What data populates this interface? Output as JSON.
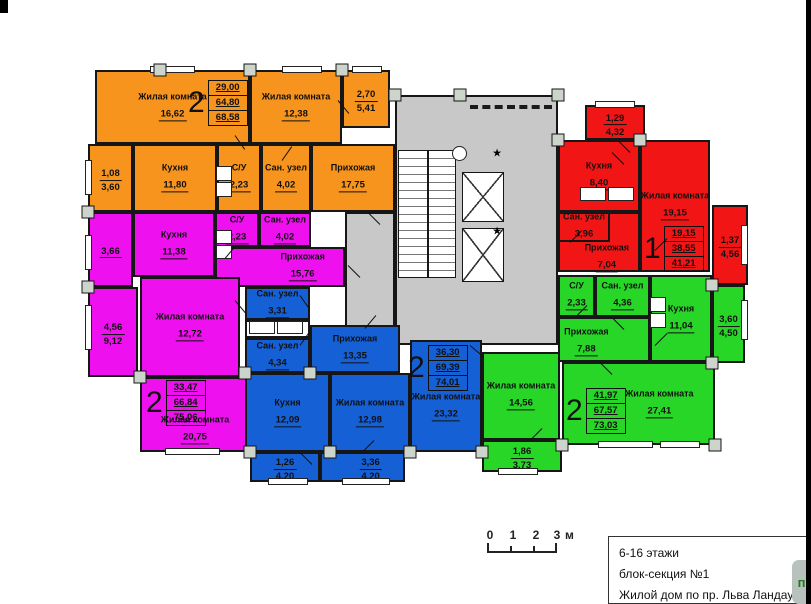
{
  "palette": {
    "or": "#F7941E",
    "mg": "#EE10EE",
    "bl": "#1660D6",
    "gr": "#28D628",
    "rd": "#F21515",
    "gray": "#C8C8C8",
    "white": "#FFFFFF"
  },
  "rooms": [
    {
      "id": "core-hall",
      "c": "gray",
      "x": 395,
      "y": 95,
      "w": 163,
      "h": 250
    },
    {
      "id": "corridor-left",
      "c": "gray",
      "x": 345,
      "y": 212,
      "w": 50,
      "h": 133
    },
    {
      "id": "or-liv1",
      "c": "or",
      "label": "Жилая комната",
      "value": "16,62",
      "x": 95,
      "y": 70,
      "w": 155,
      "h": 74
    },
    {
      "id": "or-liv2",
      "c": "or",
      "label": "Жилая комната",
      "value": "12,38",
      "x": 250,
      "y": 70,
      "w": 92,
      "h": 74
    },
    {
      "id": "or-balc1",
      "c": "or",
      "value": "2,70",
      "value2": "5,41",
      "x": 342,
      "y": 70,
      "w": 48,
      "h": 58
    },
    {
      "id": "or-balc2",
      "c": "or",
      "value": "1,08",
      "value2": "3,60",
      "x": 88,
      "y": 144,
      "w": 45,
      "h": 68
    },
    {
      "id": "or-kitchen",
      "c": "or",
      "label": "Кухня",
      "value": "11,80",
      "x": 133,
      "y": 144,
      "w": 84,
      "h": 68
    },
    {
      "id": "or-su",
      "c": "or",
      "label": "С/У",
      "value": "2,23",
      "x": 217,
      "y": 144,
      "w": 44,
      "h": 68
    },
    {
      "id": "or-san",
      "c": "or",
      "label": "Сан. узел",
      "value": "4,02",
      "x": 261,
      "y": 144,
      "w": 50,
      "h": 68
    },
    {
      "id": "or-hall",
      "c": "or",
      "label": "Прихожая",
      "value": "17,75",
      "x": 311,
      "y": 144,
      "w": 84,
      "h": 68
    },
    {
      "id": "mg-balc1",
      "c": "mg",
      "value": "3,66",
      "x": 88,
      "y": 212,
      "w": 45,
      "h": 75
    },
    {
      "id": "mg-kitchen",
      "c": "mg",
      "label": "Кухня",
      "value": "11,38",
      "x": 133,
      "y": 212,
      "w": 82,
      "h": 65
    },
    {
      "id": "mg-su",
      "c": "mg",
      "label": "С/У",
      "value": "2,23",
      "x": 215,
      "y": 212,
      "w": 44,
      "h": 35
    },
    {
      "id": "mg-san",
      "c": "mg",
      "label": "Сан. узел",
      "value": "4,02",
      "x": 259,
      "y": 212,
      "w": 52,
      "h": 35
    },
    {
      "id": "mg-hall",
      "c": "mg",
      "label": "Прихожая",
      "value": "15,76",
      "x": 215,
      "y": 247,
      "w": 130,
      "h": 40,
      "lx": 0.68
    },
    {
      "id": "mg-liv1",
      "c": "mg",
      "label": "Жилая комната",
      "value": "12,72",
      "x": 140,
      "y": 277,
      "w": 100,
      "h": 100
    },
    {
      "id": "mg-balc2",
      "c": "mg",
      "value": "4,56",
      "value2": "9,12",
      "x": 88,
      "y": 287,
      "w": 50,
      "h": 90
    },
    {
      "id": "mg-liv2",
      "c": "mg",
      "label": "Жилая комната",
      "value": "20,75",
      "x": 140,
      "y": 377,
      "w": 110,
      "h": 75,
      "ly": 0.72
    },
    {
      "id": "bl-san1",
      "c": "bl",
      "label": "Сан. узел",
      "value": "3,31",
      "x": 245,
      "y": 287,
      "w": 65,
      "h": 33
    },
    {
      "id": "bl-shelf",
      "c": "white",
      "x": 245,
      "y": 320,
      "w": 65,
      "h": 18
    },
    {
      "id": "bl-san2",
      "c": "bl",
      "label": "Сан. узел",
      "value": "4,34",
      "x": 245,
      "y": 338,
      "w": 65,
      "h": 35
    },
    {
      "id": "bl-hall",
      "c": "bl",
      "label": "Прихожая",
      "value": "13,35",
      "x": 310,
      "y": 325,
      "w": 90,
      "h": 48
    },
    {
      "id": "bl-kitchen",
      "c": "bl",
      "label": "Кухня",
      "value": "12,09",
      "x": 245,
      "y": 373,
      "w": 85,
      "h": 79
    },
    {
      "id": "bl-liv1",
      "c": "bl",
      "label": "Жилая комната",
      "value": "12,98",
      "x": 330,
      "y": 373,
      "w": 80,
      "h": 79
    },
    {
      "id": "bl-liv2",
      "c": "bl",
      "label": "Жилая комната",
      "value": "23,32",
      "x": 410,
      "y": 340,
      "w": 72,
      "h": 112,
      "ly": 0.6
    },
    {
      "id": "bl-balc1",
      "c": "bl",
      "value": "1,26",
      "value2": "4,20",
      "x": 250,
      "y": 452,
      "w": 70,
      "h": 30
    },
    {
      "id": "bl-balc2",
      "c": "bl",
      "value": "3,36",
      "value2": "4,20",
      "x": 320,
      "y": 452,
      "w": 85,
      "h": 30,
      "lx": 0.6
    },
    {
      "id": "gr-su",
      "c": "gr",
      "label": "С/У",
      "value": "2,33",
      "x": 558,
      "y": 275,
      "w": 37,
      "h": 42
    },
    {
      "id": "gr-san",
      "c": "gr",
      "label": "Сан. узел",
      "value": "4,36",
      "x": 595,
      "y": 275,
      "w": 55,
      "h": 42
    },
    {
      "id": "gr-kitchen",
      "c": "gr",
      "label": "Кухня",
      "value": "11,04",
      "x": 650,
      "y": 275,
      "w": 62,
      "h": 87
    },
    {
      "id": "gr-hall",
      "c": "gr",
      "label": "Прихожая",
      "value": "7,88",
      "x": 558,
      "y": 317,
      "w": 92,
      "h": 45,
      "lx": 0.3,
      "ly": 0.55
    },
    {
      "id": "gr-liv1",
      "c": "gr",
      "label": "Жилая комната",
      "value": "14,56",
      "x": 482,
      "y": 352,
      "w": 78,
      "h": 88
    },
    {
      "id": "gr-liv2",
      "c": "gr",
      "label": "Жилая комната",
      "value": "27,41",
      "x": 562,
      "y": 362,
      "w": 153,
      "h": 83,
      "lx": 0.64
    },
    {
      "id": "gr-balc1",
      "c": "gr",
      "value": "1,86",
      "value2": "3,73",
      "x": 482,
      "y": 440,
      "w": 80,
      "h": 32
    },
    {
      "id": "gr-balc2",
      "c": "gr",
      "value": "3,60",
      "value2": "4,50",
      "x": 712,
      "y": 285,
      "w": 33,
      "h": 78
    },
    {
      "id": "rd-balc1",
      "c": "rd",
      "value": "1,29",
      "value2": "4,32",
      "x": 585,
      "y": 105,
      "w": 60,
      "h": 35
    },
    {
      "id": "rd-kitchen",
      "c": "rd",
      "label": "Кухня",
      "value": "8,40",
      "x": 558,
      "y": 140,
      "w": 82,
      "h": 72
    },
    {
      "id": "rd-liv",
      "c": "rd",
      "label": "Жилая комната",
      "value": "19,15",
      "x": 640,
      "y": 140,
      "w": 70,
      "h": 132
    },
    {
      "id": "rd-hall",
      "c": "rd",
      "label": "Прихожая",
      "value": "7,04",
      "x": 558,
      "y": 212,
      "w": 82,
      "h": 60,
      "lx": 0.6,
      "ly": 0.78
    },
    {
      "id": "rd-san",
      "c": "rd",
      "label": "Сан. узел",
      "value": "3,96",
      "x": 558,
      "y": 212,
      "w": 52,
      "h": 30
    },
    {
      "id": "rd-balc2",
      "c": "rd",
      "value": "1,37",
      "value2": "4,56",
      "x": 712,
      "y": 205,
      "w": 36,
      "h": 80
    }
  ],
  "summaries": [
    {
      "apt": "2",
      "rows": [
        "29,00",
        "64,80",
        "68,58"
      ],
      "x": 188,
      "y": 80
    },
    {
      "apt": "2",
      "rows": [
        "33,47",
        "66,84",
        "75,06"
      ],
      "x": 146,
      "y": 380
    },
    {
      "apt": "2",
      "rows": [
        "36,30",
        "69,39",
        "74,01"
      ],
      "x": 408,
      "y": 345
    },
    {
      "apt": "2",
      "rows": [
        "41,97",
        "67,57",
        "73,03"
      ],
      "x": 566,
      "y": 388
    },
    {
      "apt": "1",
      "rows": [
        "19,15",
        "38,55",
        "41,21"
      ],
      "x": 644,
      "y": 226
    }
  ],
  "decor": {
    "stairs": {
      "x": 398,
      "y": 150,
      "w": 58,
      "h": 128
    },
    "elevators": [
      {
        "x": 462,
        "y": 172,
        "w": 42,
        "h": 50
      },
      {
        "x": 462,
        "y": 228,
        "w": 42,
        "h": 54
      }
    ],
    "stars": [
      [
        497,
        153
      ],
      [
        497,
        231
      ]
    ],
    "circle": {
      "x": 452,
      "y": 146,
      "d": 13
    },
    "dashed": {
      "x": 470,
      "y": 105,
      "w": 82
    },
    "columns": [
      [
        160,
        70
      ],
      [
        250,
        70
      ],
      [
        342,
        70
      ],
      [
        395,
        95
      ],
      [
        460,
        95
      ],
      [
        558,
        95
      ],
      [
        88,
        212
      ],
      [
        88,
        287
      ],
      [
        140,
        377
      ],
      [
        250,
        452
      ],
      [
        330,
        452
      ],
      [
        410,
        452
      ],
      [
        482,
        452
      ],
      [
        562,
        445
      ],
      [
        712,
        285
      ],
      [
        712,
        363
      ],
      [
        558,
        140
      ],
      [
        640,
        140
      ],
      [
        245,
        373
      ],
      [
        310,
        373
      ],
      [
        715,
        445
      ]
    ],
    "windows": [
      {
        "x": 150,
        "y": 66,
        "w": 45,
        "h": 7
      },
      {
        "x": 282,
        "y": 66,
        "w": 40,
        "h": 7
      },
      {
        "x": 352,
        "y": 66,
        "w": 30,
        "h": 7
      },
      {
        "x": 595,
        "y": 101,
        "w": 40,
        "h": 7
      },
      {
        "x": 85,
        "y": 160,
        "w": 7,
        "h": 35
      },
      {
        "x": 85,
        "y": 235,
        "w": 7,
        "h": 35
      },
      {
        "x": 85,
        "y": 305,
        "w": 7,
        "h": 45
      },
      {
        "x": 165,
        "y": 448,
        "w": 55,
        "h": 7
      },
      {
        "x": 268,
        "y": 478,
        "w": 40,
        "h": 7
      },
      {
        "x": 342,
        "y": 478,
        "w": 48,
        "h": 7
      },
      {
        "x": 498,
        "y": 468,
        "w": 40,
        "h": 7
      },
      {
        "x": 598,
        "y": 441,
        "w": 55,
        "h": 7
      },
      {
        "x": 660,
        "y": 441,
        "w": 40,
        "h": 7
      },
      {
        "x": 741,
        "y": 225,
        "w": 7,
        "h": 40
      },
      {
        "x": 741,
        "y": 300,
        "w": 7,
        "h": 40
      }
    ],
    "doors": [
      [
        235,
        135,
        55
      ],
      [
        282,
        160,
        -55
      ],
      [
        338,
        100,
        50
      ],
      [
        368,
        212,
        45
      ],
      [
        225,
        258,
        -50
      ],
      [
        235,
        300,
        50
      ],
      [
        348,
        265,
        45
      ],
      [
        300,
        295,
        55
      ],
      [
        300,
        345,
        -55
      ],
      [
        365,
        328,
        -50
      ],
      [
        300,
        452,
        45
      ],
      [
        362,
        452,
        -45
      ],
      [
        470,
        345,
        40
      ],
      [
        612,
        152,
        45
      ],
      [
        570,
        242,
        -45
      ],
      [
        655,
        250,
        -45
      ],
      [
        618,
        140,
        45
      ],
      [
        575,
        317,
        -45
      ],
      [
        612,
        317,
        45
      ],
      [
        655,
        345,
        -45
      ],
      [
        530,
        440,
        -45
      ],
      [
        600,
        362,
        45
      ]
    ],
    "appliance_boxes": [
      {
        "x": 216,
        "y": 166,
        "w": 16,
        "h": 15
      },
      {
        "x": 216,
        "y": 182,
        "w": 16,
        "h": 15
      },
      {
        "x": 216,
        "y": 230,
        "w": 16,
        "h": 14
      },
      {
        "x": 216,
        "y": 245,
        "w": 16,
        "h": 14
      },
      {
        "x": 249,
        "y": 321,
        "w": 26,
        "h": 13
      },
      {
        "x": 277,
        "y": 321,
        "w": 26,
        "h": 13
      },
      {
        "x": 580,
        "y": 187,
        "w": 26,
        "h": 14
      },
      {
        "x": 608,
        "y": 187,
        "w": 26,
        "h": 14
      },
      {
        "x": 650,
        "y": 297,
        "w": 16,
        "h": 15
      },
      {
        "x": 650,
        "y": 313,
        "w": 16,
        "h": 15
      }
    ]
  },
  "scale_bar": {
    "ticks": [
      "0",
      "1",
      "2",
      "3"
    ],
    "unit": "м"
  },
  "title_block": {
    "line1": "6-16 этажи",
    "line2": "блок-секция №1",
    "line3": "Жилой дом по пр. Льва Ландау, 18б"
  },
  "popup": {
    "label": "п"
  }
}
